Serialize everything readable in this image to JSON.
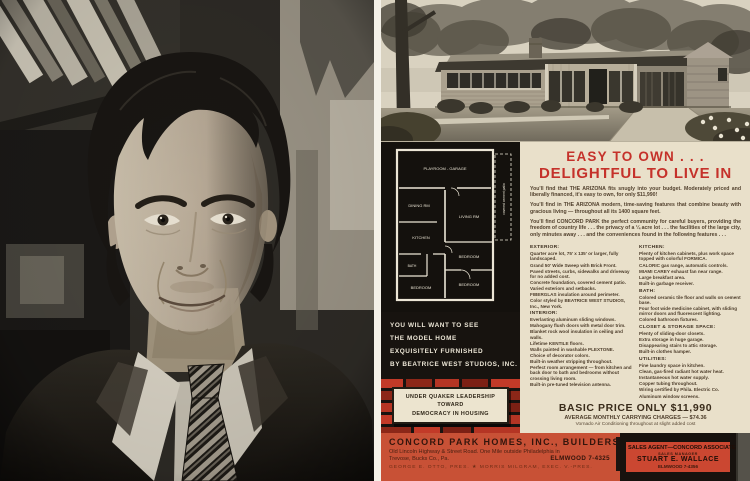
{
  "photo": {
    "description": "Black-and-white portrait photograph of a smiling man with dark wavy hair, wearing a dark suit, light shirt and striped tie, standing before bookshelves"
  },
  "ad": {
    "headline": {
      "line1": "EASY TO OWN . . .",
      "line2": "DELIGHTFUL TO LIVE IN"
    },
    "intro_paragraphs": [
      "You'll find that THE ARIZONA fits snugly into your budget.  Moderately priced and liberally financed, it's easy to own, for only $11,990!",
      "You'll find in THE ARIZONA modern, time-saving features that combine beauty with gracious living — throughout all its 1400 square feet.",
      "You'll find CONCORD PARK the perfect community for careful buyers, providing the freedom of country life . . . the privacy of a ¼ acre lot . . . the facilities of the large city, only minutes away . . . and the conveniences found in the following features . . ."
    ],
    "sections": {
      "exterior": {
        "heading": "EXTERIOR:",
        "items": [
          "Quarter acre lot, 75' x 135' or larger, fully landscaped.",
          "Grand 50' Wide Sweep with Brick Front.",
          "Paved streets, curbs, sidewalks and driveway for no added cost.",
          "Concrete foundation, covered cement patio.",
          "Varied exteriors and setbacks.",
          "FIBERGLAS insulation around perimeter.",
          "Color styled by BEATRICE WEST STUDIOS, Inc., New York."
        ]
      },
      "interior": {
        "heading": "INTERIOR:",
        "items": [
          "Everlasting aluminum sliding windows.",
          "Mahogany flush doors with metal door trim.",
          "Blanket rock wool insulation in ceiling and walls.",
          "Lifetime KENTILE floors.",
          "Walls painted in washable PLEXTONE.",
          "Choice of decorator colors.",
          "Built-in weather stripping throughout.",
          "Perfect room arrangement — from kitchen and back door to bath and bedrooms without crossing living room.",
          "Built-in pre-tuned television antenna."
        ]
      },
      "kitchen": {
        "heading": "KITCHEN:",
        "items": [
          "Plenty of kitchen cabinets, plus work space topped with colorful FORMICA.",
          "CALORIC gas range, automatic controls.",
          "MIAMI CAREY exhaust fan near range.",
          "Large breakfast area.",
          "Built-in garbage receiver."
        ]
      },
      "bath": {
        "heading": "BATH:",
        "items": [
          "Colored ceramic tile floor and walls on cement base.",
          "Four foot wide medicine cabinet, with sliding mirror doors and fluorescent lighting.",
          "Colored bathroom fixtures."
        ]
      },
      "closet": {
        "heading": "CLOSET & STORAGE SPACE:",
        "items": [
          "Plenty of sliding-door closets.",
          "Extra storage in huge garage.",
          "Disappearing stairs to attic storage.",
          "Built-in clothes hamper."
        ]
      },
      "utilities": {
        "heading": "UTILITIES:",
        "items": [
          "Fine laundry space in kitchen.",
          "Clean, gas-fired radiant hot water heat.",
          "Instantaneous hot water supply.",
          "Copper tubing throughout.",
          "Wiring certified by Phila. Electric Co.",
          "Aluminum window screens."
        ]
      },
      "playroom": {
        "heading": "PLAYROOM - GARAGE:",
        "items": [
          "Unusually large playroom - garage.",
          "Walls neatly finished and painted."
        ]
      }
    },
    "model_home_box": {
      "line1": "YOU WILL WANT TO SEE",
      "line2": "THE MODEL HOME",
      "line3": "EXQUISITELY FURNISHED",
      "line4": "BY BEATRICE WEST STUDIOS, INC."
    },
    "quaker_plaque": {
      "line1": "UNDER QUAKER LEADERSHIP",
      "line2": "TOWARD",
      "line3": "DEMOCRACY IN HOUSING"
    },
    "price": {
      "line1": "BASIC PRICE ONLY $11,990",
      "line2": "AVERAGE MONTHLY CARRYING CHARGES — $74.36",
      "line3": "Vornado Air Conditioning throughout at slight added cost"
    },
    "floor_plan": {
      "rooms": {
        "playroom": "PLAYROOM - GARAGE",
        "dining": "DINING RM",
        "living": "LIVING RM",
        "kitchen": "KITCHEN",
        "bath": "BATH",
        "bedroom_1": "BEDROOM",
        "bedroom_2": "BEDROOM",
        "bedroom_3": "BEDROOM",
        "patio": "covered cement patio"
      }
    },
    "footer": {
      "company": "CONCORD PARK HOMES, INC., BUILDERS",
      "address_line1": "Old Lincoln Highway & Street Road. One Mile outside Philadelphia in",
      "address_line2": "Trevose, Bucks Co., Pa.",
      "phone": "ELMWOOD 7-4325",
      "officers": "GEORGE E. OTTO, PRES.   ★   MORRIS MILGRAM, EXEC. V.-PRES.",
      "agent": {
        "title": "SALES AGENT—CONCORD ASSOCIATES",
        "role": "SALES MANAGER",
        "name": "STUART E. WALLACE",
        "phone": "ELMWOOD 7-4356"
      }
    },
    "colors": {
      "paper": "#e9e0ca",
      "headline_red": "#c5312a",
      "footer_red": "#c85136",
      "brick_red": "#c23a28",
      "brick_dark": "#8c2718",
      "ink": "#4e3e2c"
    }
  }
}
